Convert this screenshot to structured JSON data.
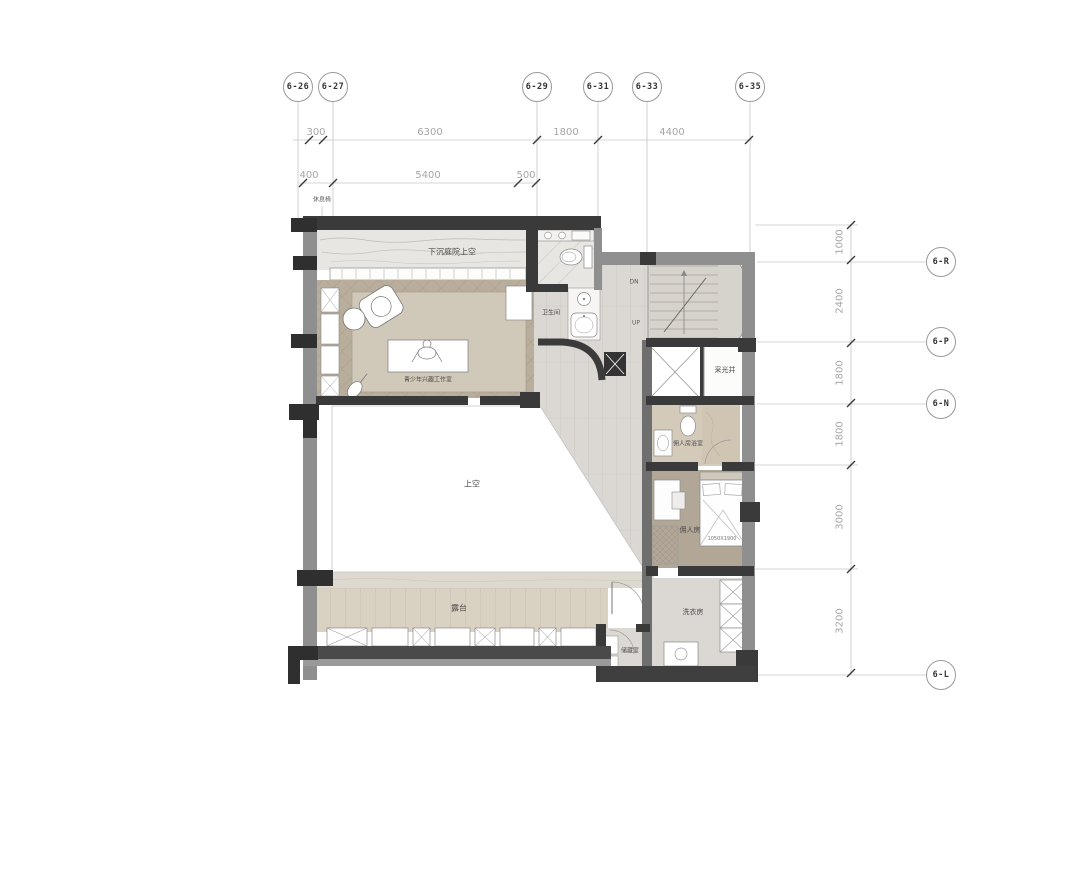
{
  "drawing_type": "architectural floor plan",
  "grid_top": {
    "bubbles": [
      {
        "label": "6-26"
      },
      {
        "label": "6-27"
      },
      {
        "label": "6-29"
      },
      {
        "label": "6-31"
      },
      {
        "label": "6-33"
      },
      {
        "label": "6-35"
      }
    ]
  },
  "grid_right": {
    "bubbles": [
      {
        "label": "6-R"
      },
      {
        "label": "6-P"
      },
      {
        "label": "6-N"
      },
      {
        "label": "6-L"
      }
    ]
  },
  "dims_top_row1": [
    {
      "value": "300"
    },
    {
      "value": "6300"
    },
    {
      "value": "1800"
    },
    {
      "value": "4400"
    }
  ],
  "dims_top_row2": [
    {
      "value": "400"
    },
    {
      "value": "5400"
    },
    {
      "value": "500"
    }
  ],
  "dims_right": [
    {
      "value": "1000"
    },
    {
      "value": "2400"
    },
    {
      "value": "1800"
    },
    {
      "value": "1800"
    },
    {
      "value": "3000"
    },
    {
      "value": "3200"
    }
  ],
  "rooms": {
    "courtyard": {
      "label": "下沉庭院上空"
    },
    "studio": {
      "label": "青少年兴趣工作室"
    },
    "bathroom": {
      "label": "卫生间"
    },
    "lightwell": {
      "label": "采光井"
    },
    "maid_bath": {
      "label": "佣人房浴室"
    },
    "maid_room": {
      "label": "佣人房"
    },
    "laundry": {
      "label": "洗衣房"
    },
    "storage": {
      "label": "储藏室"
    },
    "void": {
      "label": "上空"
    },
    "terrace": {
      "label": "露台"
    }
  },
  "annotations": {
    "wall_note": "休息椅",
    "stair_down": "DN",
    "stair_up": "UP",
    "bed_size": "1050X1900"
  },
  "colors": {
    "wall_dark": "#3a3a3a",
    "wall_gray": "#8f8f8f",
    "wood_floor": "#b9ad9c",
    "rug": "#d0c8b8",
    "tile": "#dbd8d3",
    "terrace_wood": "#d9d1c2",
    "maid_floor": "#b2a797",
    "dim_text": "#a6a6a6"
  }
}
